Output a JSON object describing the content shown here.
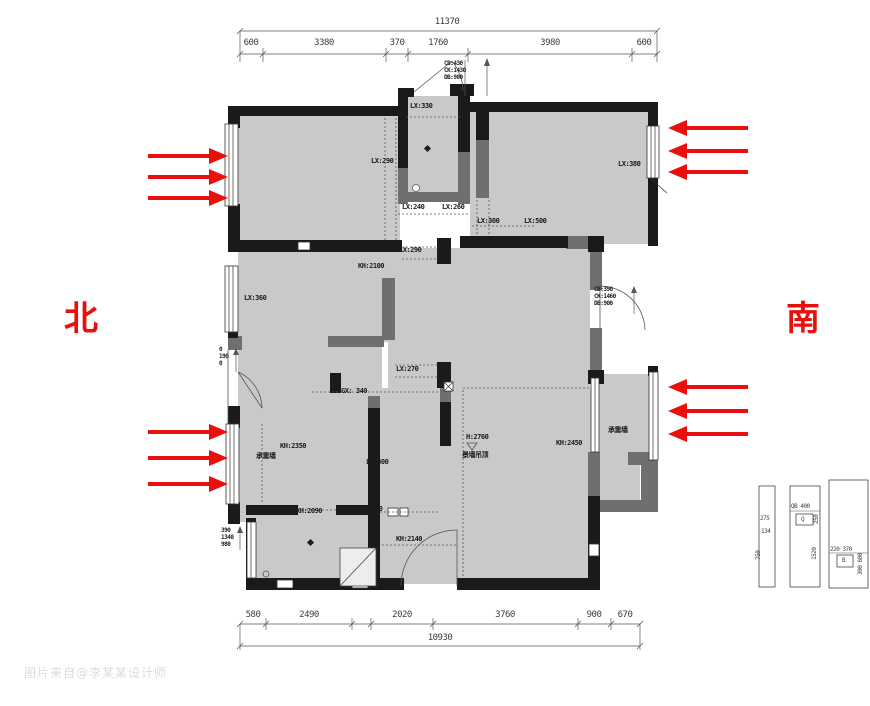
{
  "compass": {
    "north": "北",
    "south": "南"
  },
  "colors": {
    "arrow_red": "#e8100c",
    "room_fill": "#c9c9c9",
    "wall_black": "#1a1a1a",
    "wall_gray": "#6f6f6f"
  },
  "dimensions_top": {
    "total": "11370",
    "total_center": 447,
    "segments": [
      "600",
      "3380",
      "370",
      "1760",
      "3980",
      "600"
    ],
    "segment_centers": [
      251,
      324,
      397,
      438,
      550,
      644
    ]
  },
  "dimensions_bottom": {
    "total": "10930",
    "total_center": 440,
    "segments": [
      "580",
      "2490",
      "2020",
      "3760",
      "900",
      "670"
    ],
    "segment_centers": [
      253,
      309,
      402,
      505,
      594,
      625
    ]
  },
  "airflow_arrows": [
    {
      "dir": "right",
      "x": 148,
      "y": 156
    },
    {
      "dir": "right",
      "x": 148,
      "y": 177
    },
    {
      "dir": "right",
      "x": 148,
      "y": 198
    },
    {
      "dir": "right",
      "x": 148,
      "y": 432
    },
    {
      "dir": "right",
      "x": 148,
      "y": 458
    },
    {
      "dir": "right",
      "x": 148,
      "y": 484
    },
    {
      "dir": "left",
      "x": 668,
      "y": 128
    },
    {
      "dir": "left",
      "x": 668,
      "y": 151
    },
    {
      "dir": "left",
      "x": 668,
      "y": 172
    },
    {
      "dir": "left",
      "x": 668,
      "y": 387
    },
    {
      "dir": "left",
      "x": 668,
      "y": 411
    },
    {
      "dir": "left",
      "x": 668,
      "y": 434
    }
  ],
  "plan_labels": [
    {
      "text": "LX:330",
      "x": 410,
      "y": 103
    },
    {
      "text": "LX:290",
      "x": 371,
      "y": 158
    },
    {
      "text": "LX:240",
      "x": 402,
      "y": 204
    },
    {
      "text": "LX:260",
      "x": 442,
      "y": 204
    },
    {
      "text": "LX:300",
      "x": 477,
      "y": 218
    },
    {
      "text": "LX:500",
      "x": 524,
      "y": 218
    },
    {
      "text": "LX:380",
      "x": 618,
      "y": 161
    },
    {
      "text": "LX:290",
      "x": 399,
      "y": 247
    },
    {
      "text": "KH:2100",
      "x": 358,
      "y": 263
    },
    {
      "text": "LX:360",
      "x": 244,
      "y": 295
    },
    {
      "text": "LX:270",
      "x": 396,
      "y": 366
    },
    {
      "text": "GX: 340",
      "x": 341,
      "y": 388
    },
    {
      "text": "KH:2350",
      "x": 280,
      "y": 443
    },
    {
      "text": "承重墙",
      "x": 256,
      "y": 453
    },
    {
      "text": "LX:300",
      "x": 366,
      "y": 459
    },
    {
      "text": "KH:2090",
      "x": 296,
      "y": 508
    },
    {
      "text": "LX:230",
      "x": 360,
      "y": 506
    },
    {
      "text": "KH:2140",
      "x": 396,
      "y": 536
    },
    {
      "text": "H:2760",
      "x": 466,
      "y": 434
    },
    {
      "text": "景墙吊顶",
      "x": 462,
      "y": 452
    },
    {
      "text": "KH:2450",
      "x": 556,
      "y": 440
    },
    {
      "text": "承重墙",
      "x": 608,
      "y": 427
    }
  ],
  "window_notes": [
    {
      "lines": [
        "CB:430",
        "CK:1430",
        "DB:900"
      ],
      "x": 444,
      "y": 60
    },
    {
      "lines": [
        "CB:390",
        "CK:1460",
        "DB:900"
      ],
      "x": 594,
      "y": 286
    },
    {
      "lines": [
        "390",
        "1340",
        "980"
      ],
      "x": 221,
      "y": 527
    },
    {
      "lines": [
        "0",
        "190",
        "0"
      ],
      "x": 219,
      "y": 346
    }
  ],
  "legend_labels": [
    {
      "text": "275",
      "x": 760,
      "y": 516,
      "rot": false
    },
    {
      "text": "134",
      "x": 761,
      "y": 529,
      "rot": false
    },
    {
      "text": "750",
      "x": 756,
      "y": 560,
      "rot": true
    },
    {
      "text": "QB 400",
      "x": 791,
      "y": 504,
      "rot": false
    },
    {
      "text": "Q",
      "x": 801,
      "y": 517,
      "rot": false
    },
    {
      "text": "250",
      "x": 814,
      "y": 524,
      "rot": true
    },
    {
      "text": "1520",
      "x": 812,
      "y": 560,
      "rot": true
    },
    {
      "text": "220 370",
      "x": 830,
      "y": 547,
      "rot": false
    },
    {
      "text": "B",
      "x": 842,
      "y": 558,
      "rot": false
    },
    {
      "text": "300 600",
      "x": 858,
      "y": 575,
      "rot": true
    }
  ],
  "watermark": "图片来自@李某某设计师"
}
